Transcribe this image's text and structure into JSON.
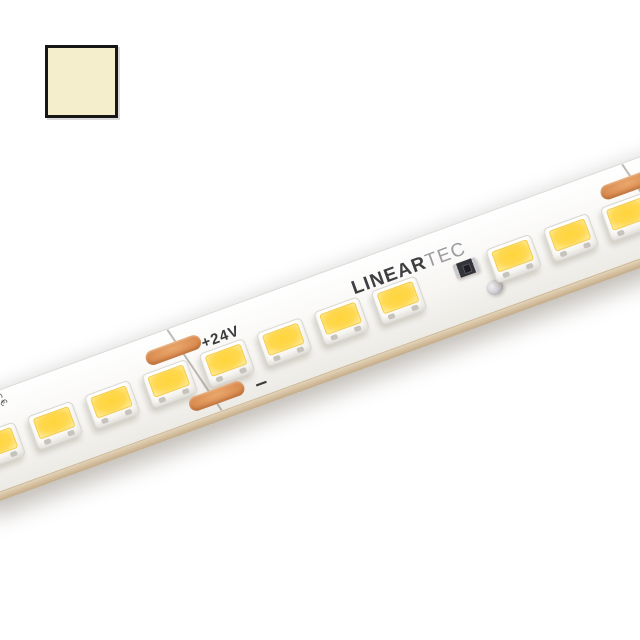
{
  "page": {
    "background": "#ffffff"
  },
  "swatch": {
    "description": "warm-white color sample square",
    "fill": "#f4eecd",
    "border": "#161616"
  },
  "strip": {
    "logo": {
      "bold": "LINEAR",
      "light": "TEC"
    },
    "labels": {
      "voltage": "+24V",
      "minus": "–",
      "ce_mark": "C€"
    },
    "angle_deg": -20,
    "led_positions": [
      38,
      99,
      160,
      221,
      282,
      343,
      404,
      465,
      587,
      648,
      709,
      770
    ],
    "cut_points": [
      250,
      734
    ],
    "resistor_slot_x": 540
  },
  "colors": {
    "swatch_fill": "#f4eecd",
    "swatch_border": "#161616",
    "pcb_face": "#f7f6f3",
    "pcb_side": "#d3bd9c",
    "pad": "#dd9055",
    "led_core": "#ffd43c",
    "logo_dark": "#3f3f42",
    "logo_light": "#9b9ba0",
    "print_dark": "#3c3c3e"
  }
}
